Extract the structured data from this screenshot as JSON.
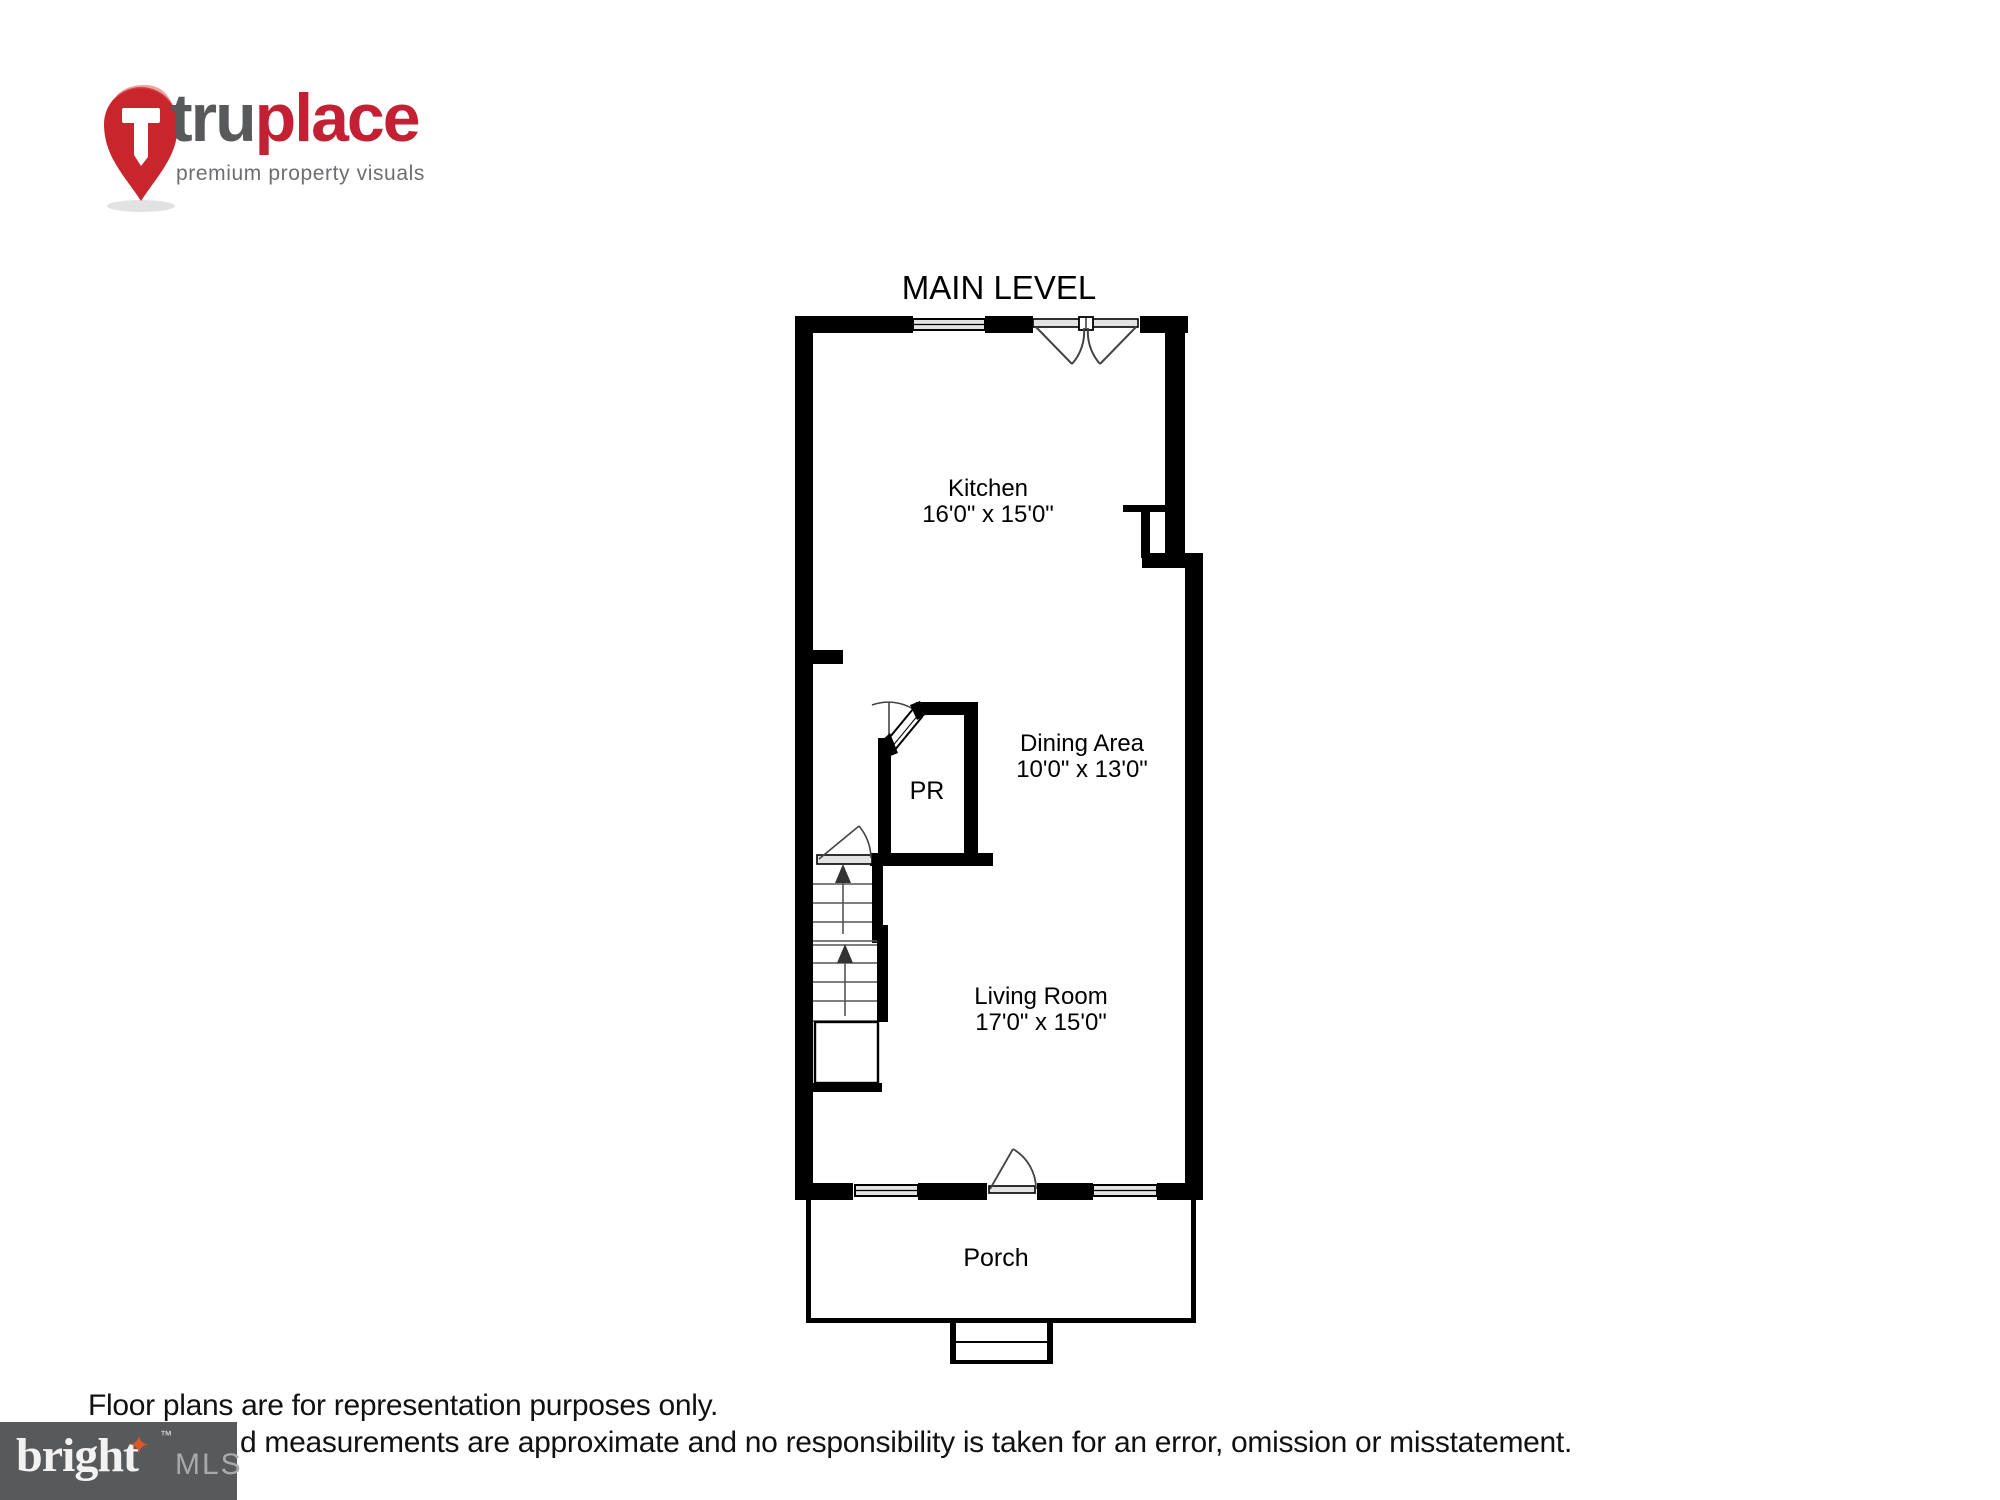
{
  "branding": {
    "truplace": {
      "word_part1": "tru",
      "word_part2": "place",
      "tagline": "premium property visuals",
      "pin_letter_color": "#ffffff",
      "pin_color": "#c9252c",
      "part1_color": "#58595b",
      "part2_color": "#c32133"
    },
    "bright_mls": {
      "word": "bright",
      "trademark": "™",
      "star": "✦",
      "suffix": "MLS",
      "bg_color": "#58595b",
      "star_color": "#d9572b"
    }
  },
  "plan": {
    "title": "MAIN LEVEL",
    "rooms": [
      {
        "id": "kitchen",
        "name": "Kitchen",
        "dims": "16'0\" x 15'0\""
      },
      {
        "id": "dining",
        "name": "Dining Area",
        "dims": "10'0\" x 13'0\""
      },
      {
        "id": "living",
        "name": "Living Room",
        "dims": "17'0\" x 15'0\""
      },
      {
        "id": "pr",
        "name": "PR",
        "dims": ""
      },
      {
        "id": "porch",
        "name": "Porch",
        "dims": ""
      }
    ],
    "wall_color": "#000000",
    "window_fill": "#e3e3e3",
    "swing_color": "#444444"
  },
  "footer": {
    "line1": "Floor plans are for representation purposes only.",
    "line2": "d measurements are approximate and no responsibility is taken for an error, omission or misstatement."
  }
}
